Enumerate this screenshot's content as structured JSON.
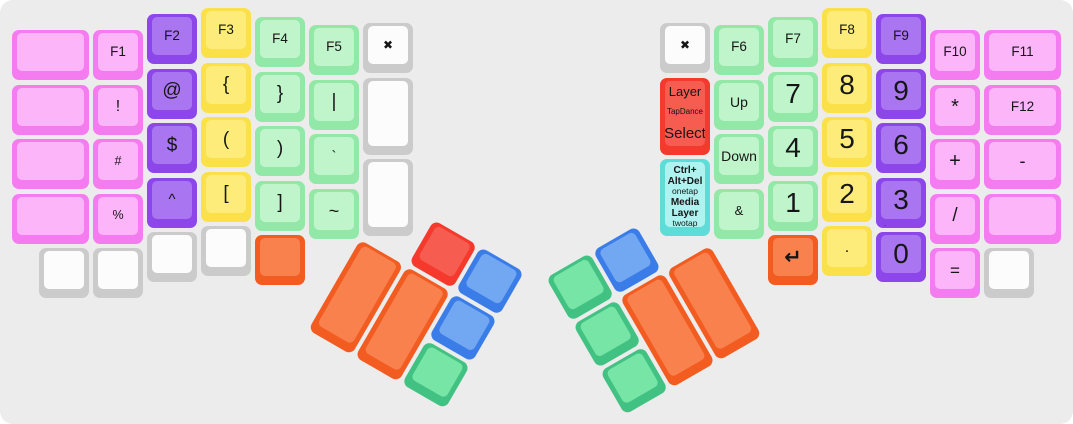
{
  "app": {
    "description": "split ergonomic keyboard layout view",
    "canvas_bg": "#ececec",
    "canvas_width": 1073,
    "canvas_height": 424
  },
  "palette": {
    "pink": {
      "base": "#f57cf0",
      "top": "#fbb5f8"
    },
    "purple": {
      "base": "#8c46e9",
      "top": "#a975f1"
    },
    "yellow": {
      "base": "#fbe149",
      "top": "#fdec79"
    },
    "green": {
      "base": "#91e8a7",
      "top": "#c0f5cb"
    },
    "white": {
      "base": "#cbcbcb",
      "top": "#fcfcfc"
    },
    "red": {
      "base": "#f53a2d",
      "top": "#f75c50"
    },
    "cyan": {
      "base": "#5edcd8",
      "top": "#aff3f1"
    },
    "orange": {
      "base": "#f35c20",
      "top": "#f8814e"
    },
    "blue": {
      "base": "#3b7de8",
      "top": "#72a8f2"
    },
    "emerald": {
      "base": "#42c282",
      "top": "#76e5a6"
    }
  },
  "geometry": {
    "row_pitch": 54.5,
    "key_size": 50
  },
  "keyboard": {
    "columns": [
      {
        "side": "left",
        "x": 12,
        "top": 30,
        "w": 77,
        "keys": [
          {
            "r": 0,
            "c": "pink"
          },
          {
            "r": 1,
            "c": "pink"
          },
          {
            "r": 2,
            "c": "pink"
          },
          {
            "r": 3,
            "c": "pink"
          },
          {
            "r": 4,
            "c": "white",
            "w": 50,
            "dx": 27
          }
        ]
      },
      {
        "side": "left",
        "x": 93,
        "top": 30,
        "keys": [
          {
            "r": 0,
            "c": "pink",
            "t": "F1",
            "fs": 13.5,
            "n": "key-f1"
          },
          {
            "r": 1,
            "c": "pink",
            "t": "!",
            "fs": 16,
            "n": "key-exclamation"
          },
          {
            "r": 2,
            "c": "pink",
            "t": "#",
            "fs": 12.5,
            "n": "key-hash"
          },
          {
            "r": 3,
            "c": "pink",
            "t": "%",
            "fs": 12.5,
            "n": "key-percent"
          },
          {
            "r": 4,
            "c": "white"
          }
        ]
      },
      {
        "side": "left",
        "x": 147,
        "top": 14,
        "keys": [
          {
            "r": 0,
            "c": "purple",
            "t": "F2",
            "fs": 13.5,
            "n": "key-f2"
          },
          {
            "r": 1,
            "c": "purple",
            "t": "@",
            "fs": 19,
            "n": "key-at"
          },
          {
            "r": 2,
            "c": "purple",
            "t": "$",
            "fs": 19,
            "n": "key-dollar"
          },
          {
            "r": 3,
            "c": "purple",
            "t": "^",
            "fs": 15,
            "n": "key-caret"
          },
          {
            "r": 4,
            "c": "white"
          }
        ]
      },
      {
        "side": "left",
        "x": 201,
        "top": 8,
        "keys": [
          {
            "r": 0,
            "c": "yellow",
            "t": "F3",
            "fs": 13.5,
            "n": "key-f3"
          },
          {
            "r": 1,
            "c": "yellow",
            "t": "{",
            "fs": 19,
            "n": "key-left-brace"
          },
          {
            "r": 2,
            "c": "yellow",
            "t": "(",
            "fs": 19,
            "n": "key-left-paren"
          },
          {
            "r": 3,
            "c": "yellow",
            "t": "[",
            "fs": 19,
            "n": "key-left-bracket"
          },
          {
            "r": 4,
            "c": "white"
          }
        ]
      },
      {
        "side": "left",
        "x": 255,
        "top": 17,
        "keys": [
          {
            "r": 0,
            "c": "green",
            "t": "F4",
            "fs": 13.5,
            "n": "key-f4"
          },
          {
            "r": 1,
            "c": "green",
            "t": "}",
            "fs": 19,
            "n": "key-right-brace"
          },
          {
            "r": 2,
            "c": "green",
            "t": ")",
            "fs": 19,
            "n": "key-right-paren"
          },
          {
            "r": 3,
            "c": "green",
            "t": "]",
            "fs": 19,
            "n": "key-right-bracket"
          },
          {
            "r": 4,
            "c": "orange",
            "n": "key-orange-blank"
          }
        ]
      },
      {
        "side": "left",
        "x": 309,
        "top": 25,
        "keys": [
          {
            "r": 0,
            "c": "green",
            "t": "F5",
            "fs": 13.5,
            "n": "key-f5"
          },
          {
            "r": 1,
            "c": "green",
            "t": "|",
            "fs": 19,
            "n": "key-pipe"
          },
          {
            "r": 2,
            "c": "green",
            "t": "`",
            "fs": 15,
            "n": "key-backtick"
          },
          {
            "r": 3,
            "c": "green",
            "t": "~",
            "fs": 18,
            "n": "key-tilde"
          }
        ]
      },
      {
        "side": "left",
        "x": 363,
        "top": 23,
        "keys": [
          {
            "r": 0,
            "c": "white",
            "t": "✖",
            "fs": 12,
            "n": "key-x-left"
          },
          {
            "r": 1,
            "c": "white",
            "h": 77
          },
          {
            "r": 2.5,
            "c": "white",
            "h": 77
          }
        ]
      },
      {
        "side": "right",
        "x": 660,
        "top": 23,
        "keys": [
          {
            "r": 0,
            "c": "white",
            "t": "✖",
            "fs": 12,
            "n": "key-x-right"
          },
          {
            "r": 1,
            "c": "red",
            "h": 77,
            "n": "key-layer-tapdance-select",
            "lines": [
              {
                "t": "Layer",
                "fs": 13
              },
              {
                "t": "TapDance",
                "fs": 8
              },
              {
                "t": "Select",
                "fs": 15
              }
            ]
          },
          {
            "r": 2.5,
            "c": "cyan",
            "h": 77,
            "n": "key-ctrl-alt-del-media-layer",
            "lines": [
              {
                "t": "Ctrl+",
                "fs": 10,
                "b": true
              },
              {
                "t": "Alt+Del",
                "fs": 10,
                "b": true
              },
              {
                "t": "onetap",
                "fs": 8.5
              },
              {
                "t": "Media",
                "fs": 10,
                "b": true,
                "gap": 2
              },
              {
                "t": "Layer",
                "fs": 10,
                "b": true
              },
              {
                "t": "twotap",
                "fs": 8.5
              }
            ]
          }
        ]
      },
      {
        "side": "right",
        "x": 714,
        "top": 25,
        "keys": [
          {
            "r": 0,
            "c": "green",
            "t": "F6",
            "fs": 13.5,
            "n": "key-f6"
          },
          {
            "r": 1,
            "c": "green",
            "t": "Up",
            "fs": 14,
            "n": "key-up"
          },
          {
            "r": 2,
            "c": "green",
            "t": "Down",
            "fs": 14,
            "n": "key-down"
          },
          {
            "r": 3,
            "c": "green",
            "t": "&",
            "fs": 13,
            "n": "key-ampersand"
          }
        ]
      },
      {
        "side": "right",
        "x": 768,
        "top": 17,
        "keys": [
          {
            "r": 0,
            "c": "green",
            "t": "F7",
            "fs": 13.5,
            "n": "key-f7"
          },
          {
            "r": 1,
            "c": "green",
            "t": "7",
            "fs": 28,
            "n": "key-7"
          },
          {
            "r": 2,
            "c": "green",
            "t": "4",
            "fs": 28,
            "n": "key-4"
          },
          {
            "r": 3,
            "c": "green",
            "t": "1",
            "fs": 28,
            "n": "key-1"
          },
          {
            "r": 4,
            "c": "orange",
            "t": "↵",
            "fs": 21,
            "b": true,
            "n": "key-enter"
          }
        ]
      },
      {
        "side": "right",
        "x": 822,
        "top": 8,
        "keys": [
          {
            "r": 0,
            "c": "yellow",
            "t": "F8",
            "fs": 13.5,
            "n": "key-f8"
          },
          {
            "r": 1,
            "c": "yellow",
            "t": "8",
            "fs": 28,
            "n": "key-8"
          },
          {
            "r": 2,
            "c": "yellow",
            "t": "5",
            "fs": 28,
            "n": "key-5"
          },
          {
            "r": 3,
            "c": "yellow",
            "t": "2",
            "fs": 28,
            "n": "key-2"
          },
          {
            "r": 4,
            "c": "yellow",
            "t": ".",
            "fs": 16,
            "n": "key-period"
          }
        ]
      },
      {
        "side": "right",
        "x": 876,
        "top": 14,
        "keys": [
          {
            "r": 0,
            "c": "purple",
            "t": "F9",
            "fs": 13.5,
            "n": "key-f9"
          },
          {
            "r": 1,
            "c": "purple",
            "t": "9",
            "fs": 28,
            "n": "key-9"
          },
          {
            "r": 2,
            "c": "purple",
            "t": "6",
            "fs": 28,
            "n": "key-6"
          },
          {
            "r": 3,
            "c": "purple",
            "t": "3",
            "fs": 28,
            "sub": ".",
            "n": "key-3"
          },
          {
            "r": 4,
            "c": "purple",
            "t": "0",
            "fs": 28,
            "n": "key-0"
          }
        ]
      },
      {
        "side": "right",
        "x": 930,
        "top": 30,
        "keys": [
          {
            "r": 0,
            "c": "pink",
            "t": "F10",
            "fs": 13.5,
            "n": "key-f10"
          },
          {
            "r": 1,
            "c": "pink",
            "t": "*",
            "fs": 20,
            "n": "key-asterisk"
          },
          {
            "r": 2,
            "c": "pink",
            "t": "+",
            "fs": 20,
            "n": "key-plus"
          },
          {
            "r": 3,
            "c": "pink",
            "t": "/",
            "fs": 19,
            "n": "key-slash"
          },
          {
            "r": 4,
            "c": "pink",
            "t": "=",
            "fs": 17,
            "n": "key-equals"
          }
        ]
      },
      {
        "side": "right",
        "x": 984,
        "top": 30,
        "w": 77,
        "keys": [
          {
            "r": 0,
            "c": "pink",
            "t": "F11",
            "fs": 13.5,
            "n": "key-f11"
          },
          {
            "r": 1,
            "c": "pink",
            "t": "F12",
            "fs": 13.5,
            "n": "key-f12"
          },
          {
            "r": 2,
            "c": "pink",
            "t": "-",
            "fs": 18,
            "n": "key-minus"
          },
          {
            "r": 3,
            "c": "pink"
          },
          {
            "r": 4,
            "c": "white",
            "w": 50
          }
        ]
      }
    ],
    "thumb_clusters": [
      {
        "name": "thumb-cluster-left",
        "x": 434,
        "y": 220,
        "angle": 30,
        "keys": [
          {
            "x": -54,
            "y": 54,
            "w": 50,
            "h": 104,
            "c": "orange",
            "n": "thumb-key-orange-outer"
          },
          {
            "x": 0,
            "y": 54,
            "w": 50,
            "h": 104,
            "c": "orange",
            "n": "thumb-key-orange-inner"
          },
          {
            "x": 0,
            "y": 0,
            "w": 50,
            "h": 50,
            "c": "red",
            "n": "thumb-key-red"
          },
          {
            "x": 54,
            "y": 0,
            "w": 50,
            "h": 50,
            "c": "blue",
            "n": "thumb-key-blue-1"
          },
          {
            "x": 54,
            "y": 54,
            "w": 50,
            "h": 50,
            "c": "blue",
            "n": "thumb-key-blue-2"
          },
          {
            "x": 54,
            "y": 108,
            "w": 50,
            "h": 50,
            "c": "emerald",
            "n": "thumb-key-green"
          }
        ]
      },
      {
        "name": "thumb-cluster-right",
        "x": 546,
        "y": 278,
        "angle": -30,
        "keys": [
          {
            "x": 54,
            "y": 54,
            "w": 50,
            "h": 104,
            "c": "orange",
            "n": "thumb-key-orange-inner"
          },
          {
            "x": 108,
            "y": 54,
            "w": 50,
            "h": 104,
            "c": "orange",
            "n": "thumb-key-orange-outer"
          },
          {
            "x": 0,
            "y": 0,
            "w": 50,
            "h": 50,
            "c": "emerald",
            "n": "thumb-key-green-1"
          },
          {
            "x": 54,
            "y": 0,
            "w": 50,
            "h": 50,
            "c": "blue",
            "n": "thumb-key-blue"
          },
          {
            "x": 0,
            "y": 54,
            "w": 50,
            "h": 50,
            "c": "emerald",
            "n": "thumb-key-green-2"
          },
          {
            "x": 0,
            "y": 108,
            "w": 50,
            "h": 50,
            "c": "emerald",
            "n": "thumb-key-green-3"
          }
        ]
      }
    ]
  }
}
